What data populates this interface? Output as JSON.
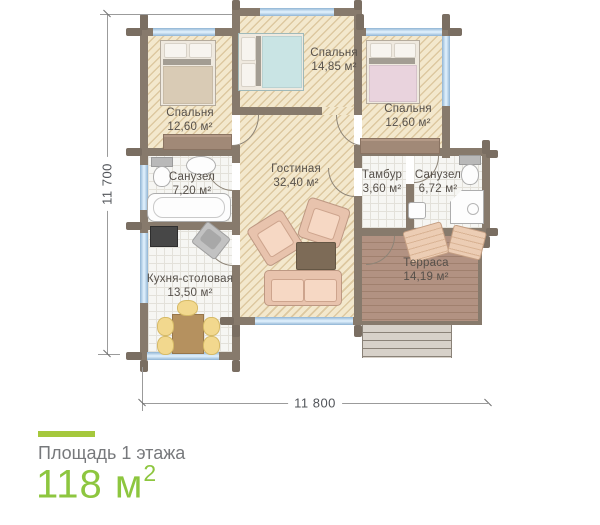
{
  "plan": {
    "rooms": [
      {
        "name": "Спальня",
        "area": "12,60 м²"
      },
      {
        "name": "Спальня",
        "area": "14,85 м²"
      },
      {
        "name": "Спальня",
        "area": "12,60 м²"
      },
      {
        "name": "Санузел",
        "area": "7,20 м²"
      },
      {
        "name": "Гостиная",
        "area": "32,40 м²"
      },
      {
        "name": "Тамбур",
        "area": "3,60 м²"
      },
      {
        "name": "Санузел",
        "area": "6,72 м²"
      },
      {
        "name": "Кухня-столовая",
        "area": "13,50 м²"
      },
      {
        "name": "Терраса",
        "area": "14,19 м²"
      }
    ],
    "dimensions": {
      "height": "11 700",
      "width": "11 800"
    }
  },
  "footer": {
    "label": "Площадь 1 этажа",
    "value": "118",
    "unit": "м",
    "unit_sup": "2"
  },
  "colors": {
    "accent_green": "#8dc63f",
    "bar_green": "#a5c83c",
    "wall": "#877a6c",
    "floor_beige": "#f3e8cd",
    "terrace_brown": "#b29282",
    "window_blue": "#ddeefb"
  }
}
